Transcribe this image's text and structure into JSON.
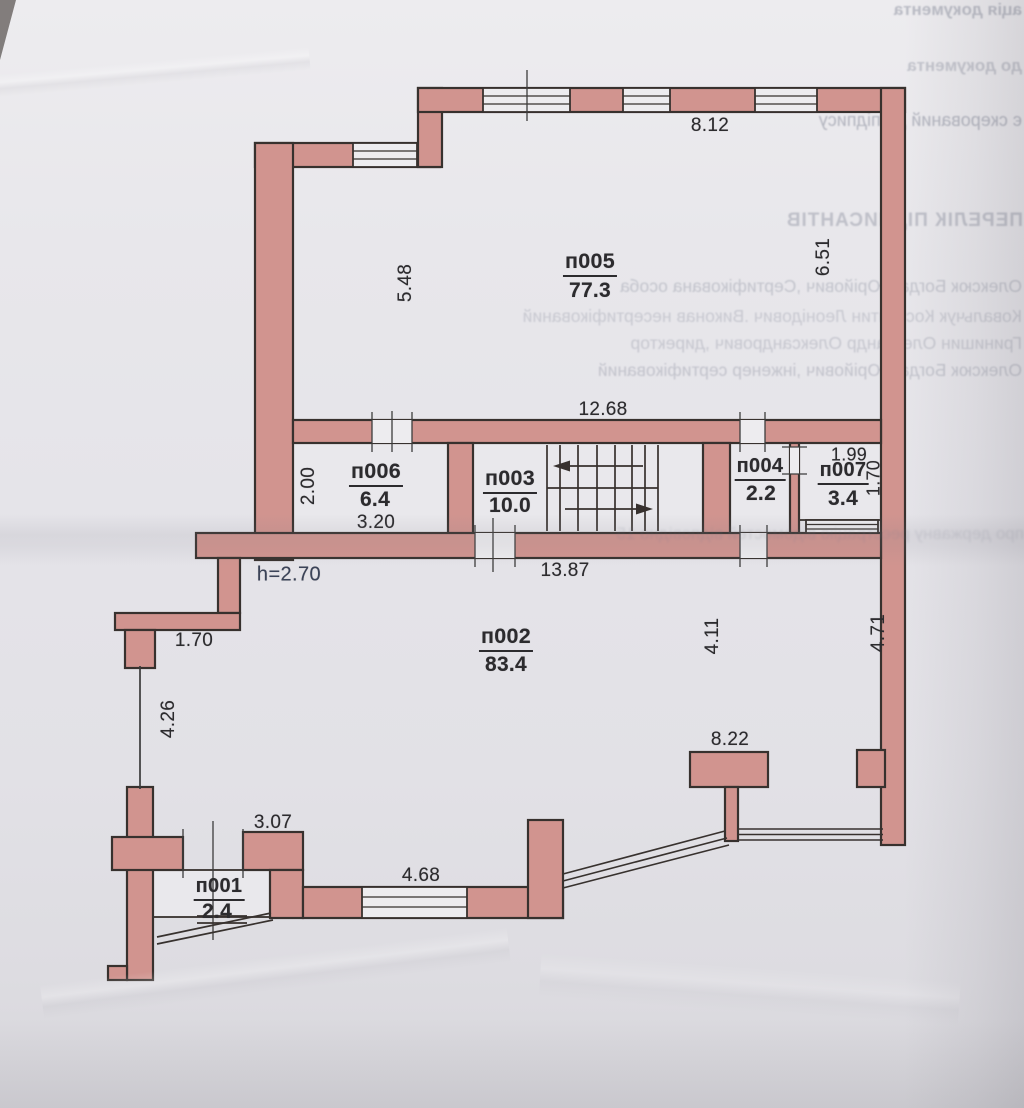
{
  "rooms": [
    {
      "name": "п005",
      "area": "77.3"
    },
    {
      "name": "п006",
      "area": "6.4"
    },
    {
      "name": "п003",
      "area": "10.0"
    },
    {
      "name": "п004",
      "area": "2.2"
    },
    {
      "name": "п007",
      "area": "3.4"
    },
    {
      "name": "п002",
      "area": "83.4"
    },
    {
      "name": "п001",
      "area": "2.4"
    }
  ],
  "dims": [
    {
      "v": "8.12"
    },
    {
      "v": "5.48"
    },
    {
      "v": "6.51"
    },
    {
      "v": "12.68"
    },
    {
      "v": "2.00"
    },
    {
      "v": "3.20"
    },
    {
      "v": "1.99"
    },
    {
      "v": "1.70"
    },
    {
      "v": "13.87"
    },
    {
      "v": "h=2.70"
    },
    {
      "v": "1.70"
    },
    {
      "v": "4.26"
    },
    {
      "v": "4.11"
    },
    {
      "v": "4.71"
    },
    {
      "v": "8.22"
    },
    {
      "v": "3.07"
    },
    {
      "v": "4.68"
    }
  ],
  "bleedthrough": [
    {
      "t": "ація документа"
    },
    {
      "t": "до документа"
    },
    {
      "t": "є скерований до підпису"
    },
    {
      "t": "ПЕРЕЛІК ПІДПИСАНТІВ"
    },
    {
      "t": "Олексюк Богдан Юрійович ,Сертифікована особа"
    },
    {
      "t": "Ковальчук Костянтин Леонідович .Виконав несертифікований"
    },
    {
      "t": "Гринишин Олександр Олександрович ,директор"
    },
    {
      "t": "Олексюк Богдан Юрійович ,інженер сертифікований"
    },
    {
      "t": "про державну реєстрацію відомостей відповідно 15"
    }
  ],
  "colors": {
    "wall": "#d1948f",
    "outline": "#37312e",
    "opening": "#edecef",
    "height_note": "#3b4358"
  }
}
